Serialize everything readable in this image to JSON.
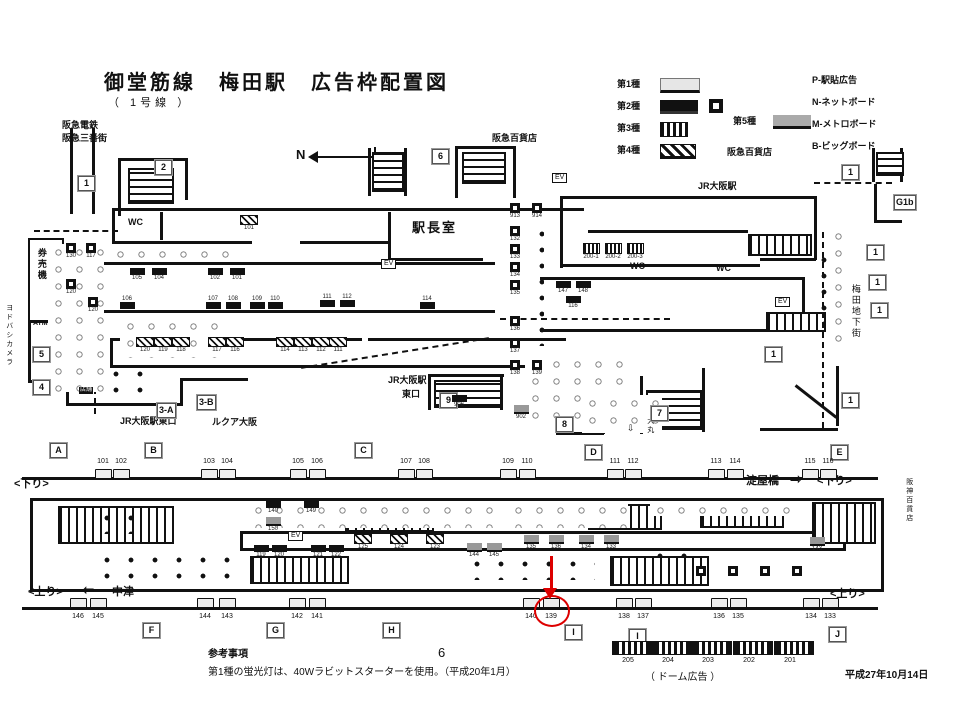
{
  "title": {
    "main": "御堂筋線　梅田駅　広告枠配置図",
    "sub": "（ 1号線 ）"
  },
  "compass": {
    "label": "N"
  },
  "legend": {
    "types": [
      {
        "label": "第1種",
        "cls": "sw1",
        "x": 617,
        "y": 80
      },
      {
        "label": "第2種",
        "cls": "sw2",
        "x": 617,
        "y": 102
      },
      {
        "label": "第3種",
        "cls": "sw3",
        "x": 617,
        "y": 124
      },
      {
        "label": "第4種",
        "cls": "sw4",
        "x": 617,
        "y": 146
      }
    ],
    "type5": {
      "label": "第5種",
      "cls": "sw5",
      "x": 733,
      "y": 117
    },
    "codes": [
      {
        "label": "P-駅貼広告",
        "x": 812,
        "y": 76
      },
      {
        "label": "N-ネットボード",
        "x": 812,
        "y": 98
      },
      {
        "label": "M-メトロボード",
        "x": 812,
        "y": 120
      },
      {
        "label": "B-ビッグボード",
        "x": 812,
        "y": 142
      }
    ],
    "hankyu_dept": {
      "label": "阪急百貨店",
      "x": 727,
      "y": 148
    }
  },
  "map": {
    "labels": [
      {
        "t": "阪急電鉄",
        "x": 62,
        "y": 121,
        "cls": "sm b"
      },
      {
        "t": "阪急三番街",
        "x": 62,
        "y": 134,
        "cls": "sm b"
      },
      {
        "t": "阪急百貨店",
        "x": 492,
        "y": 134,
        "cls": "sm b"
      },
      {
        "t": "JR大阪駅",
        "x": 698,
        "y": 182,
        "cls": "sm b"
      },
      {
        "t": "駅長室",
        "x": 412,
        "y": 221,
        "cls": "lg"
      },
      {
        "t": "WC",
        "x": 128,
        "y": 218,
        "cls": "sm b"
      },
      {
        "t": "WC",
        "x": 630,
        "y": 262,
        "cls": "sm b"
      },
      {
        "t": "WC",
        "x": 716,
        "y": 264,
        "cls": "sm b"
      },
      {
        "t": "EV",
        "x": 552,
        "y": 173,
        "cls": "boxed"
      },
      {
        "t": "EV",
        "x": 381,
        "y": 259,
        "cls": "boxed"
      },
      {
        "t": "EV",
        "x": 775,
        "y": 297,
        "cls": "boxed"
      },
      {
        "t": "EV",
        "x": 288,
        "y": 531,
        "cls": "boxed"
      },
      {
        "t": "券売機",
        "x": 36,
        "y": 248,
        "cls": "v sm b"
      },
      {
        "t": "ATM",
        "x": 33,
        "y": 320,
        "cls": "xs b"
      },
      {
        "t": "ヨドバシカメラ",
        "x": 5,
        "y": 304,
        "cls": "v xs"
      },
      {
        "t": "店舗",
        "x": 79,
        "y": 387,
        "cls": "inv"
      },
      {
        "t": "JR大阪駅東口",
        "x": 120,
        "y": 417,
        "cls": "sm b"
      },
      {
        "t": "ルクア大阪",
        "x": 212,
        "y": 418,
        "cls": "sm b"
      },
      {
        "t": "JR大阪駅",
        "x": 388,
        "y": 376,
        "cls": "sm b"
      },
      {
        "t": "東口",
        "x": 402,
        "y": 390,
        "cls": "sm b"
      },
      {
        "t": "大丸",
        "x": 646,
        "y": 417,
        "cls": "v xs"
      },
      {
        "t": "⇩",
        "x": 627,
        "y": 424,
        "cls": "sm"
      },
      {
        "t": "梅田地下街",
        "x": 850,
        "y": 284,
        "cls": "v sm"
      },
      {
        "t": "阪神百貨店",
        "x": 905,
        "y": 478,
        "cls": "v xs"
      },
      {
        "t": "淀屋橋",
        "x": 746,
        "y": 475,
        "cls": "b"
      },
      {
        "t": "⇨",
        "x": 790,
        "y": 472,
        "cls": "arrowch"
      },
      {
        "t": "<下り>",
        "x": 817,
        "y": 475,
        "cls": "b"
      },
      {
        "t": "<下り>",
        "x": 14,
        "y": 478,
        "cls": "b"
      },
      {
        "t": "<上り>",
        "x": 28,
        "y": 586,
        "cls": "b"
      },
      {
        "t": "⇦",
        "x": 82,
        "y": 583,
        "cls": "arrowch"
      },
      {
        "t": "中津",
        "x": 112,
        "y": 586,
        "cls": "b"
      },
      {
        "t": "<上り>",
        "x": 830,
        "y": 588,
        "cls": "b"
      }
    ],
    "boxes": [
      {
        "t": "1",
        "x": 78,
        "y": 176
      },
      {
        "t": "2",
        "x": 155,
        "y": 160
      },
      {
        "t": "6",
        "x": 432,
        "y": 149
      },
      {
        "t": "1",
        "x": 842,
        "y": 165
      },
      {
        "t": "G1b",
        "x": 894,
        "y": 195
      },
      {
        "t": "5",
        "x": 33,
        "y": 347
      },
      {
        "t": "4",
        "x": 33,
        "y": 380
      },
      {
        "t": "3-A",
        "x": 157,
        "y": 403
      },
      {
        "t": "3-B",
        "x": 197,
        "y": 395
      },
      {
        "t": "9",
        "x": 440,
        "y": 393
      },
      {
        "t": "8",
        "x": 556,
        "y": 417
      },
      {
        "t": "7",
        "x": 651,
        "y": 406
      },
      {
        "t": "1",
        "x": 765,
        "y": 347
      },
      {
        "t": "1",
        "x": 842,
        "y": 393
      },
      {
        "t": "1",
        "x": 867,
        "y": 245
      },
      {
        "t": "1",
        "x": 869,
        "y": 275
      },
      {
        "t": "1",
        "x": 871,
        "y": 303
      },
      {
        "t": "A",
        "x": 50,
        "y": 443
      },
      {
        "t": "B",
        "x": 145,
        "y": 443
      },
      {
        "t": "C",
        "x": 355,
        "y": 443
      },
      {
        "t": "D",
        "x": 585,
        "y": 445
      },
      {
        "t": "E",
        "x": 831,
        "y": 445
      },
      {
        "t": "F",
        "x": 143,
        "y": 623
      },
      {
        "t": "G",
        "x": 267,
        "y": 623
      },
      {
        "t": "H",
        "x": 383,
        "y": 623
      },
      {
        "t": "I",
        "x": 565,
        "y": 625
      },
      {
        "t": "I",
        "x": 629,
        "y": 629
      },
      {
        "t": "J",
        "x": 829,
        "y": 627
      }
    ],
    "ads": [
      {
        "n": "130",
        "x": 60,
        "y": 243,
        "v": "dw"
      },
      {
        "n": "117",
        "x": 80,
        "y": 243,
        "v": "dw"
      },
      {
        "n": "120",
        "x": 60,
        "y": 279,
        "v": "dw"
      },
      {
        "n": "120",
        "x": 82,
        "y": 297,
        "v": "dw"
      },
      {
        "n": "101",
        "x": 238,
        "y": 215,
        "v": "h"
      },
      {
        "n": "105",
        "x": 126,
        "y": 268,
        "v": "d"
      },
      {
        "n": "104",
        "x": 148,
        "y": 268,
        "v": "d"
      },
      {
        "n": "102",
        "x": 204,
        "y": 268,
        "v": "d"
      },
      {
        "n": "101",
        "x": 226,
        "y": 268,
        "v": "d"
      },
      {
        "n": "106",
        "x": 116,
        "y": 296,
        "v": "d",
        "la": "t"
      },
      {
        "n": "107",
        "x": 202,
        "y": 296,
        "v": "d",
        "la": "t"
      },
      {
        "n": "108",
        "x": 222,
        "y": 296,
        "v": "d",
        "la": "t"
      },
      {
        "n": "109",
        "x": 246,
        "y": 296,
        "v": "d",
        "la": "t"
      },
      {
        "n": "110",
        "x": 264,
        "y": 296,
        "v": "d",
        "la": "t"
      },
      {
        "n": "111",
        "x": 316,
        "y": 294,
        "v": "d",
        "la": "t"
      },
      {
        "n": "112",
        "x": 336,
        "y": 294,
        "v": "d",
        "la": "t"
      },
      {
        "n": "114",
        "x": 416,
        "y": 296,
        "v": "d",
        "la": "t"
      },
      {
        "n": "120",
        "x": 134,
        "y": 337,
        "v": "h"
      },
      {
        "n": "119",
        "x": 152,
        "y": 337,
        "v": "h"
      },
      {
        "n": "118",
        "x": 170,
        "y": 337,
        "v": "h"
      },
      {
        "n": "117",
        "x": 206,
        "y": 337,
        "v": "h"
      },
      {
        "n": "116",
        "x": 224,
        "y": 337,
        "v": "h"
      },
      {
        "n": "114",
        "x": 274,
        "y": 337,
        "v": "h"
      },
      {
        "n": "113",
        "x": 292,
        "y": 337,
        "v": "h"
      },
      {
        "n": "112",
        "x": 310,
        "y": 337,
        "v": "h"
      },
      {
        "n": "111",
        "x": 327,
        "y": 337,
        "v": "h"
      },
      {
        "n": "913",
        "x": 504,
        "y": 203,
        "v": "dw"
      },
      {
        "n": "914",
        "x": 526,
        "y": 203,
        "v": "dw"
      },
      {
        "n": "132",
        "x": 504,
        "y": 226,
        "v": "dw"
      },
      {
        "n": "133",
        "x": 504,
        "y": 244,
        "v": "dw"
      },
      {
        "n": "134",
        "x": 504,
        "y": 262,
        "v": "dw"
      },
      {
        "n": "135",
        "x": 504,
        "y": 280,
        "v": "dw"
      },
      {
        "n": "136",
        "x": 504,
        "y": 316,
        "v": "dw"
      },
      {
        "n": "137",
        "x": 504,
        "y": 338,
        "v": "dw"
      },
      {
        "n": "138",
        "x": 504,
        "y": 360,
        "v": "dw"
      },
      {
        "n": "139",
        "x": 526,
        "y": 360,
        "v": "dw"
      },
      {
        "n": "200-1",
        "x": 580,
        "y": 243,
        "v": "vs"
      },
      {
        "n": "200-2",
        "x": 602,
        "y": 243,
        "v": "vs"
      },
      {
        "n": "200-3",
        "x": 624,
        "y": 243,
        "v": "vs"
      },
      {
        "n": "147",
        "x": 552,
        "y": 281,
        "v": "d"
      },
      {
        "n": "148",
        "x": 572,
        "y": 281,
        "v": "d"
      },
      {
        "n": "116",
        "x": 562,
        "y": 296,
        "v": "d"
      },
      {
        "n": "906",
        "x": 448,
        "y": 395,
        "v": "d"
      },
      {
        "n": "902",
        "x": 510,
        "y": 405,
        "v": "g"
      }
    ],
    "island_ads": [
      {
        "n": "140",
        "x": 262,
        "y": 501,
        "v": "d"
      },
      {
        "n": "149",
        "x": 300,
        "y": 501,
        "v": "d"
      },
      {
        "n": "150",
        "x": 262,
        "y": 517,
        "v": "g"
      },
      {
        "n": "119",
        "x": 250,
        "y": 545,
        "v": "d",
        "la": "b"
      },
      {
        "n": "120",
        "x": 268,
        "y": 545,
        "v": "d",
        "la": "b"
      },
      {
        "n": "121",
        "x": 307,
        "y": 545,
        "v": "d",
        "la": "b"
      },
      {
        "n": "122",
        "x": 325,
        "y": 545,
        "v": "d",
        "la": "b"
      },
      {
        "n": "125",
        "x": 352,
        "y": 534,
        "v": "h"
      },
      {
        "n": "124",
        "x": 388,
        "y": 534,
        "v": "h"
      },
      {
        "n": "123",
        "x": 424,
        "y": 534,
        "v": "h"
      },
      {
        "n": "144",
        "x": 463,
        "y": 543,
        "v": "g",
        "la": "b"
      },
      {
        "n": "145",
        "x": 483,
        "y": 543,
        "v": "g",
        "la": "b"
      },
      {
        "n": "135",
        "x": 520,
        "y": 535,
        "v": "g"
      },
      {
        "n": "136",
        "x": 545,
        "y": 535,
        "v": "g"
      },
      {
        "n": "134",
        "x": 575,
        "y": 535,
        "v": "g"
      },
      {
        "n": "133",
        "x": 600,
        "y": 535,
        "v": "g"
      },
      {
        "n": "143",
        "x": 806,
        "y": 537,
        "v": "g"
      },
      {
        "n": "",
        "x": 690,
        "y": 566,
        "v": "dw"
      },
      {
        "n": "",
        "x": 722,
        "y": 566,
        "v": "dw"
      },
      {
        "n": "",
        "x": 754,
        "y": 566,
        "v": "dw"
      },
      {
        "n": "",
        "x": 786,
        "y": 566,
        "v": "dw"
      }
    ]
  },
  "platform": {
    "top_numbers": [
      {
        "t": "101",
        "x": 103
      },
      {
        "t": "102",
        "x": 121
      },
      {
        "t": "103",
        "x": 209
      },
      {
        "t": "104",
        "x": 227
      },
      {
        "t": "105",
        "x": 298
      },
      {
        "t": "106",
        "x": 317
      },
      {
        "t": "107",
        "x": 406
      },
      {
        "t": "108",
        "x": 424
      },
      {
        "t": "109",
        "x": 508
      },
      {
        "t": "110",
        "x": 527
      },
      {
        "t": "111",
        "x": 615
      },
      {
        "t": "112",
        "x": 633
      },
      {
        "t": "113",
        "x": 716
      },
      {
        "t": "114",
        "x": 735
      },
      {
        "t": "115",
        "x": 810
      },
      {
        "t": "116",
        "x": 828
      }
    ],
    "bottom_numbers": [
      {
        "t": "146",
        "x": 78
      },
      {
        "t": "145",
        "x": 98
      },
      {
        "t": "144",
        "x": 205
      },
      {
        "t": "143",
        "x": 227
      },
      {
        "t": "142",
        "x": 297
      },
      {
        "t": "141",
        "x": 317
      },
      {
        "t": "140",
        "x": 531
      },
      {
        "t": "139",
        "x": 551,
        "hl": true
      },
      {
        "t": "138",
        "x": 624
      },
      {
        "t": "137",
        "x": 643
      },
      {
        "t": "136",
        "x": 719
      },
      {
        "t": "135",
        "x": 738
      },
      {
        "t": "134",
        "x": 811
      },
      {
        "t": "133",
        "x": 830
      }
    ],
    "dome": {
      "items": [
        {
          "t": "205",
          "x": 612
        },
        {
          "t": "204",
          "x": 652
        },
        {
          "t": "203",
          "x": 692
        },
        {
          "t": "202",
          "x": 733
        },
        {
          "t": "201",
          "x": 774
        }
      ],
      "caption": "（ ドーム広告 ）"
    }
  },
  "notes": {
    "heading": "参考事項",
    "page": "6",
    "line": "第1種の蛍光灯は、40Wラビットスターターを使用。（平成20年1月）",
    "date": "平成27年10月14日"
  },
  "colors": {
    "red": "#dd0000",
    "ink": "#111111"
  }
}
